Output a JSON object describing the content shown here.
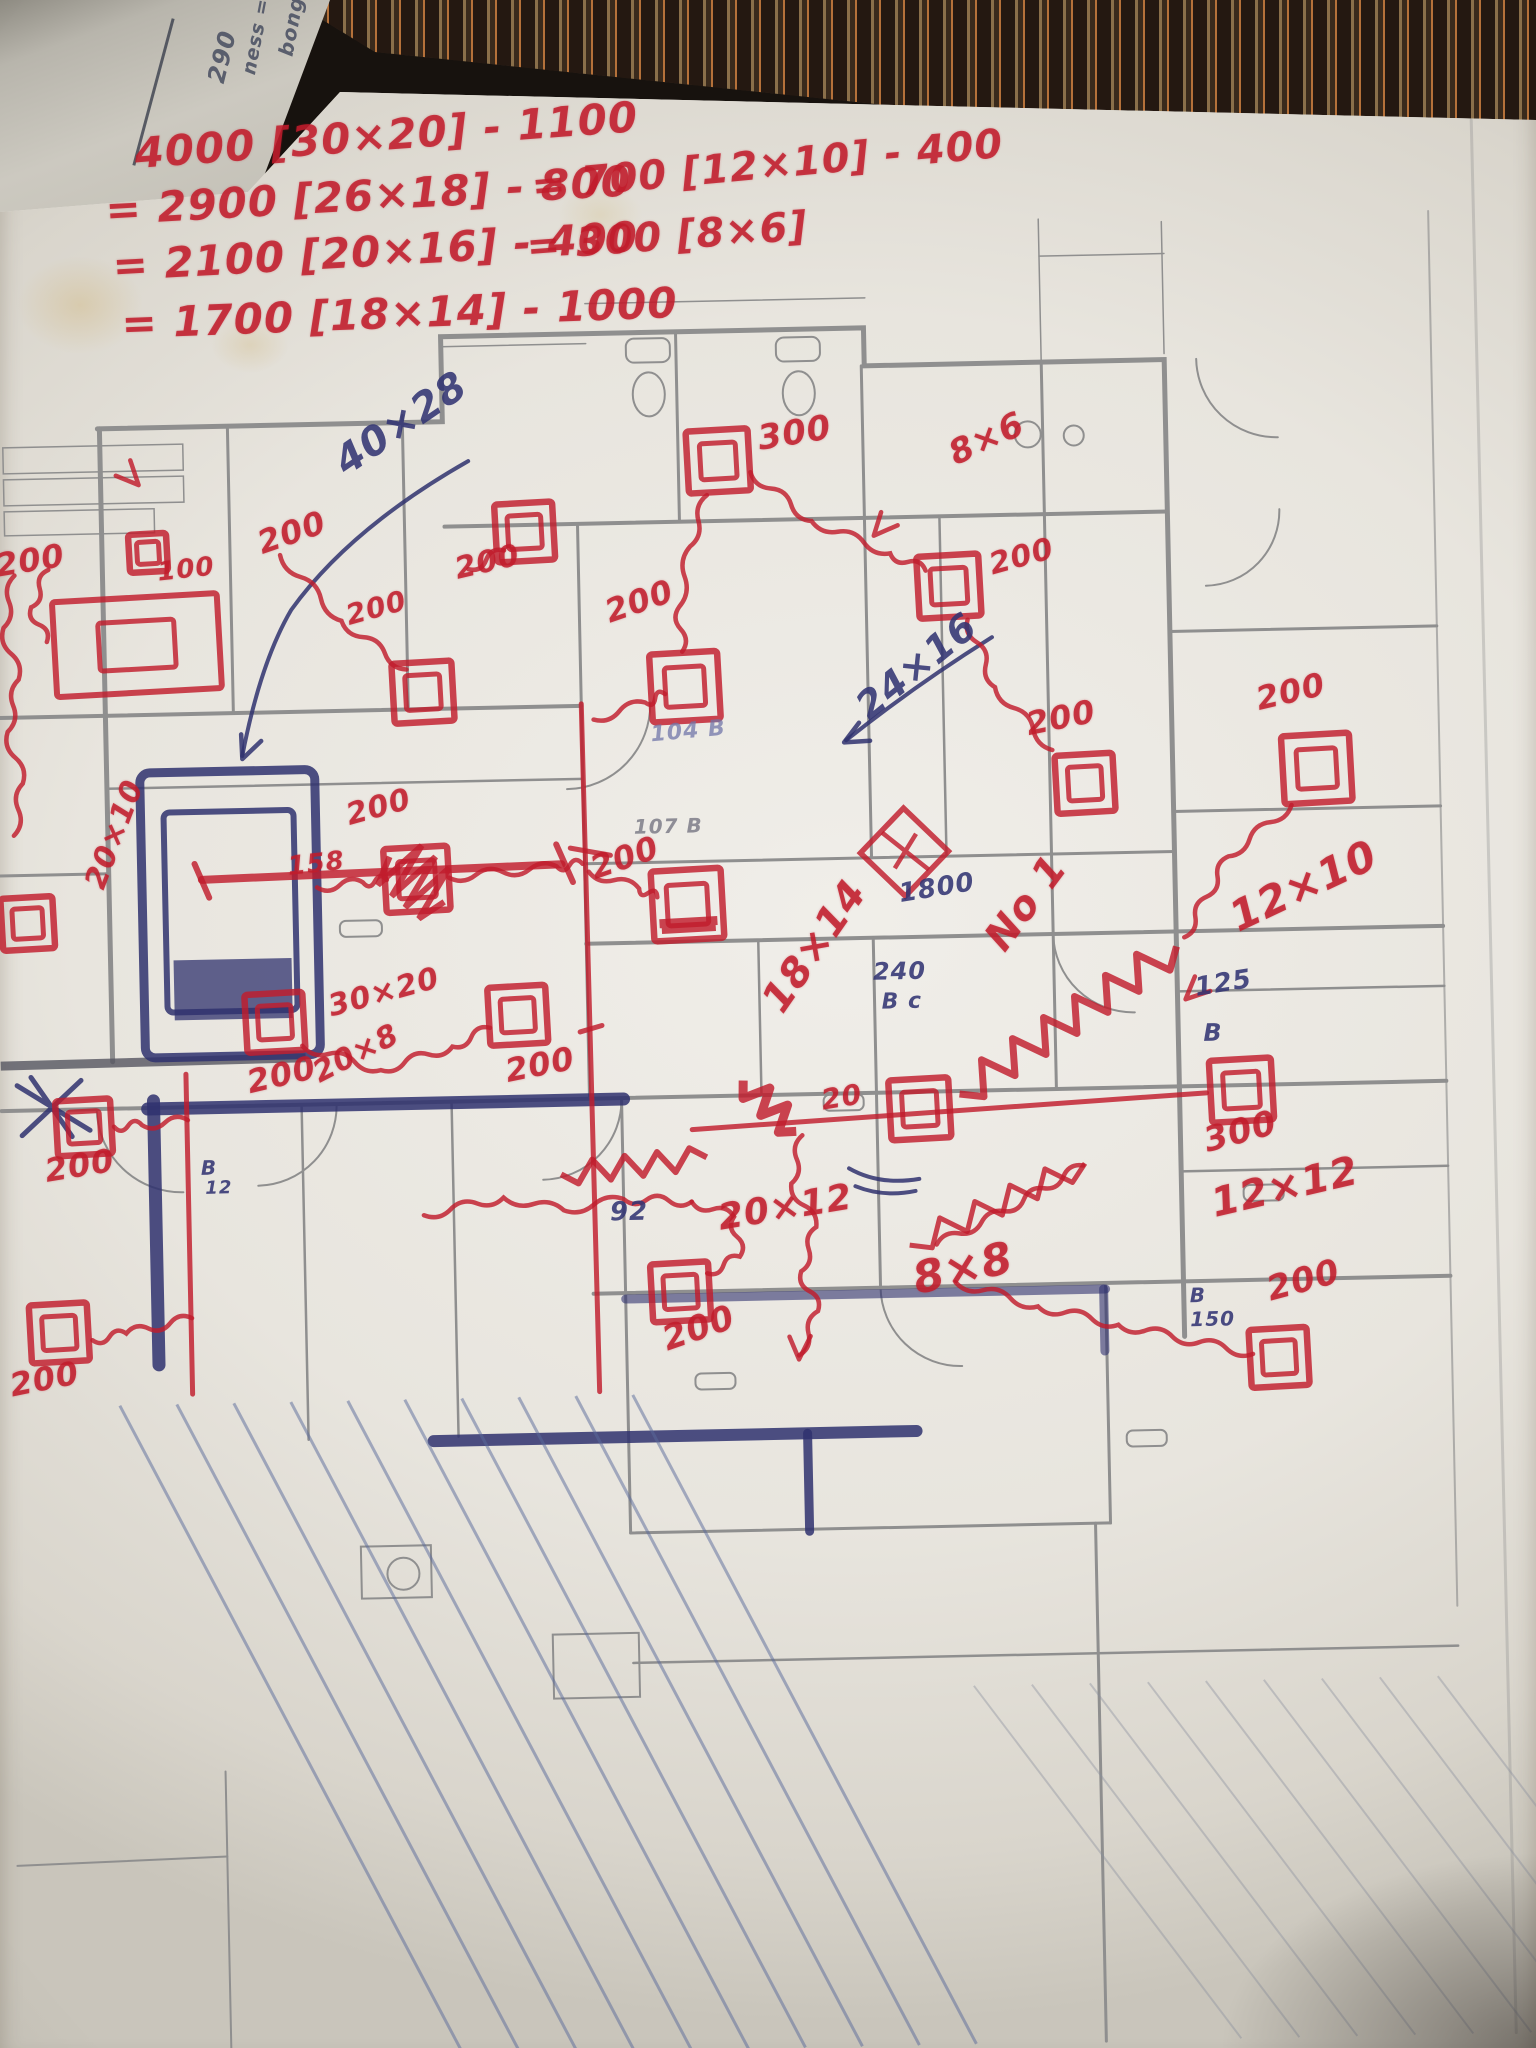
{
  "colors": {
    "red_marker": "#c11c2c",
    "blue_pen": "#32346f",
    "pencil": "#767682",
    "plan_gray": "#8f8f8f"
  },
  "side_sheet": {
    "lines": [
      {
        "text": "bong = 6",
        "x": 296,
        "y": 44,
        "rot": -78,
        "size": 20
      },
      {
        "text": "ness =",
        "x": 260,
        "y": 62,
        "rot": -78,
        "size": 19
      },
      {
        "text": "290",
        "x": 224,
        "y": 68,
        "rot": -75,
        "size": 24
      }
    ]
  },
  "calc_notes": [
    {
      "text": "4000 [30×20] - 1100",
      "x": 152,
      "y": 120,
      "rot": -3,
      "size": 42,
      "ink": "red"
    },
    {
      "text": "= 2900 [26×18] - 800",
      "x": 122,
      "y": 176,
      "rot": -2,
      "size": 42,
      "ink": "red"
    },
    {
      "text": "= 2100 [20×16] - 400",
      "x": 128,
      "y": 232,
      "rot": -2,
      "size": 42,
      "ink": "red"
    },
    {
      "text": "= 1700 [18×14] - 1000",
      "x": 136,
      "y": 290,
      "rot": -1,
      "size": 42,
      "ink": "red"
    },
    {
      "text": "= 700 [12×10] - 400",
      "x": 548,
      "y": 162,
      "rot": -4,
      "size": 40,
      "ink": "red"
    },
    {
      "text": "= 300 [8×6]",
      "x": 542,
      "y": 222,
      "rot": -3,
      "size": 40,
      "ink": "red"
    }
  ],
  "plan_labels": [
    {
      "text": "200",
      "x": 3,
      "y": 534,
      "rot": -8,
      "size": 32,
      "ink": "red"
    },
    {
      "text": "100",
      "x": 166,
      "y": 547,
      "rot": -5,
      "size": 26,
      "ink": "red"
    },
    {
      "text": "200",
      "x": 264,
      "y": 518,
      "rot": -18,
      "size": 32,
      "ink": "red"
    },
    {
      "text": "200",
      "x": 462,
      "y": 549,
      "rot": -12,
      "size": 30,
      "ink": "red"
    },
    {
      "text": "200",
      "x": 352,
      "y": 594,
      "rot": -14,
      "size": 28,
      "ink": "red"
    },
    {
      "text": "40×28",
      "x": 340,
      "y": 440,
      "rot": -33,
      "size": 40,
      "ink": "blue"
    },
    {
      "text": "300",
      "x": 768,
      "y": 422,
      "rot": -8,
      "size": 34,
      "ink": "red"
    },
    {
      "text": "8×6",
      "x": 956,
      "y": 444,
      "rot": -24,
      "size": 34,
      "ink": "red"
    },
    {
      "text": "200",
      "x": 996,
      "y": 556,
      "rot": -14,
      "size": 30,
      "ink": "red"
    },
    {
      "text": "200",
      "x": 1030,
      "y": 714,
      "rot": -10,
      "size": 32,
      "ink": "red"
    },
    {
      "text": "200",
      "x": 1260,
      "y": 694,
      "rot": -12,
      "size": 32,
      "ink": "red"
    },
    {
      "text": "200",
      "x": 610,
      "y": 594,
      "rot": -18,
      "size": 32,
      "ink": "red"
    },
    {
      "text": "24×16",
      "x": 856,
      "y": 698,
      "rot": -38,
      "size": 38,
      "ink": "blue"
    },
    {
      "text": "104 B",
      "x": 656,
      "y": 722,
      "rot": -4,
      "size": 22,
      "ink": "fadedblue"
    },
    {
      "text": "107 B",
      "x": 638,
      "y": 814,
      "rot": 0,
      "size": 20,
      "ink": "pencil"
    },
    {
      "text": "200",
      "x": 590,
      "y": 850,
      "rot": -18,
      "size": 32,
      "ink": "red"
    },
    {
      "text": "158",
      "x": 290,
      "y": 844,
      "rot": -5,
      "size": 26,
      "ink": "red"
    },
    {
      "text": "200",
      "x": 348,
      "y": 793,
      "rot": -14,
      "size": 30,
      "ink": "red"
    },
    {
      "text": "30×20",
      "x": 326,
      "y": 984,
      "rot": -14,
      "size": 30,
      "ink": "red"
    },
    {
      "text": "20×10",
      "x": 84,
      "y": 868,
      "rot": -68,
      "size": 30,
      "ink": "red"
    },
    {
      "text": "20×8",
      "x": 308,
      "y": 1052,
      "rot": -26,
      "size": 30,
      "ink": "red"
    },
    {
      "text": "1800",
      "x": 900,
      "y": 884,
      "rot": -8,
      "size": 26,
      "ink": "blue"
    },
    {
      "text": "18×14",
      "x": 756,
      "y": 996,
      "rot": -54,
      "size": 40,
      "ink": "red"
    },
    {
      "text": "240",
      "x": 874,
      "y": 962,
      "rot": 0,
      "size": 24,
      "ink": "blue"
    },
    {
      "text": "B c",
      "x": 882,
      "y": 994,
      "rot": 0,
      "size": 22,
      "ink": "blue"
    },
    {
      "text": "No 1",
      "x": 980,
      "y": 938,
      "rot": -52,
      "size": 40,
      "ink": "red"
    },
    {
      "text": "125",
      "x": 1194,
      "y": 984,
      "rot": -8,
      "size": 26,
      "ink": "blue"
    },
    {
      "text": "12×10",
      "x": 1226,
      "y": 910,
      "rot": -24,
      "size": 42,
      "ink": "red"
    },
    {
      "text": "B",
      "x": 1203,
      "y": 1030,
      "rot": 0,
      "size": 24,
      "ink": "blue"
    },
    {
      "text": "300",
      "x": 1198,
      "y": 1134,
      "rot": -14,
      "size": 34,
      "ink": "red"
    },
    {
      "text": "12×12",
      "x": 1204,
      "y": 1194,
      "rot": -12,
      "size": 40,
      "ink": "red"
    },
    {
      "text": "20",
      "x": 818,
      "y": 1088,
      "rot": -8,
      "size": 28,
      "ink": "red"
    },
    {
      "text": "92",
      "x": 606,
      "y": 1196,
      "rot": 0,
      "size": 26,
      "ink": "blue"
    },
    {
      "text": "20×12",
      "x": 712,
      "y": 1200,
      "rot": -8,
      "size": 36,
      "ink": "red"
    },
    {
      "text": "8×8",
      "x": 904,
      "y": 1262,
      "rot": -12,
      "size": 44,
      "ink": "red"
    },
    {
      "text": "200",
      "x": 652,
      "y": 1322,
      "rot": -18,
      "size": 34,
      "ink": "red"
    },
    {
      "text": "200",
      "x": 40,
      "y": 1140,
      "rot": -8,
      "size": 32,
      "ink": "red"
    },
    {
      "text": "200",
      "x": 0,
      "y": 1354,
      "rot": -10,
      "size": 32,
      "ink": "red"
    },
    {
      "text": "200",
      "x": 243,
      "y": 1056,
      "rot": -12,
      "size": 32,
      "ink": "red"
    },
    {
      "text": "200",
      "x": 502,
      "y": 1050,
      "rot": -10,
      "size": 32,
      "ink": "red"
    },
    {
      "text": "200",
      "x": 1258,
      "y": 1284,
      "rot": -14,
      "size": 34,
      "ink": "red"
    },
    {
      "text": "B",
      "x": 1184,
      "y": 1294,
      "rot": 0,
      "size": 20,
      "ink": "blue"
    },
    {
      "text": "150",
      "x": 1184,
      "y": 1318,
      "rot": 0,
      "size": 20,
      "ink": "blue"
    },
    {
      "text": "B",
      "x": 198,
      "y": 1146,
      "rot": 0,
      "size": 20,
      "ink": "blue"
    },
    {
      "text": "12",
      "x": 202,
      "y": 1168,
      "rot": 0,
      "size": 18,
      "ink": "blue"
    }
  ],
  "diffusers": [
    {
      "cx": 145,
      "cy": 632,
      "w": 165,
      "h": 95
    },
    {
      "cx": 158,
      "cy": 540,
      "s": 38
    },
    {
      "cx": 730,
      "cy": 460,
      "s": 62
    },
    {
      "cx": 430,
      "cy": 685,
      "s": 60
    },
    {
      "cx": 535,
      "cy": 527,
      "s": 58
    },
    {
      "cx": 692,
      "cy": 685,
      "s": 68
    },
    {
      "cx": 958,
      "cy": 590,
      "s": 62
    },
    {
      "cx": 1090,
      "cy": 790,
      "s": 58
    },
    {
      "cx": 1322,
      "cy": 780,
      "s": 68
    },
    {
      "cx": 420,
      "cy": 872,
      "s": 64,
      "scribble": true
    },
    {
      "cx": 690,
      "cy": 903,
      "s": 70,
      "fill": true
    },
    {
      "cx": 918,
      "cy": 1112,
      "s": 60
    },
    {
      "cx": 1240,
      "cy": 1100,
      "s": 62
    },
    {
      "cx": 675,
      "cy": 1290,
      "s": 58
    },
    {
      "cx": 82,
      "cy": 1113,
      "s": 55
    },
    {
      "cx": 53,
      "cy": 1318,
      "s": 58
    },
    {
      "cx": 30,
      "cy": 908,
      "s": 52
    },
    {
      "cx": 275,
      "cy": 1012,
      "s": 58
    },
    {
      "cx": 518,
      "cy": 1010,
      "s": 58
    },
    {
      "cx": 1272,
      "cy": 1368,
      "s": 58
    }
  ],
  "fd_symbol": {
    "cx": 908,
    "cy": 855,
    "r": 44
  },
  "ducts": [
    {
      "pts": [
        [
          58,
          555
        ],
        [
          40,
          592
        ],
        [
          55,
          627
        ]
      ]
    },
    {
      "pts": [
        [
          290,
          545
        ],
        [
          350,
          612
        ],
        [
          414,
          662
        ]
      ]
    },
    {
      "pts": [
        [
          478,
          563
        ],
        [
          514,
          545
        ]
      ]
    },
    {
      "pts": [
        [
          600,
          716
        ],
        [
          652,
          700
        ],
        [
          672,
          692
        ]
      ]
    },
    {
      "pts": [
        [
          762,
          472
        ],
        [
          822,
          522
        ],
        [
          900,
          556
        ],
        [
          935,
          574
        ]
      ]
    },
    {
      "pts": [
        [
          718,
          494
        ],
        [
          700,
          545
        ],
        [
          688,
          605
        ],
        [
          690,
          650
        ]
      ]
    },
    {
      "pts": [
        [
          976,
          624
        ],
        [
          1002,
          692
        ],
        [
          1058,
          756
        ]
      ]
    },
    {
      "pts": [
        [
          1186,
          946
        ],
        [
          1232,
          866
        ],
        [
          1296,
          816
        ]
      ]
    },
    {
      "pts": [
        [
          320,
          878
        ],
        [
          366,
          874
        ],
        [
          390,
          872
        ]
      ]
    },
    {
      "pts": [
        [
          452,
          871
        ],
        [
          560,
          862
        ],
        [
          586,
          860
        ]
      ]
    },
    {
      "pts": [
        [
          592,
          868
        ],
        [
          642,
          886
        ],
        [
          660,
          895
        ]
      ]
    },
    {
      "pts": [
        [
          1080,
          1172
        ],
        [
          1000,
          1216
        ],
        [
          932,
          1248
        ]
      ]
    },
    {
      "pts": [
        [
          950,
          1286
        ],
        [
          1032,
          1312
        ],
        [
          1112,
          1332
        ],
        [
          1246,
          1364
        ]
      ]
    },
    {
      "pts": [
        [
          420,
          1208
        ],
        [
          500,
          1192
        ],
        [
          560,
          1206
        ],
        [
          620,
          1196
        ],
        [
          688,
          1200
        ]
      ]
    },
    {
      "pts": [
        [
          688,
          1200
        ],
        [
          730,
          1216
        ],
        [
          735,
          1256
        ],
        [
          702,
          1272
        ]
      ]
    },
    {
      "pts": [
        [
          186,
          1108
        ],
        [
          140,
          1112
        ],
        [
          112,
          1113
        ]
      ]
    },
    {
      "pts": [
        [
          186,
          1306
        ],
        [
          120,
          1320
        ],
        [
          86,
          1326
        ]
      ]
    },
    {
      "pts": [
        [
          24,
          560
        ],
        [
          12,
          612
        ],
        [
          26,
          664
        ],
        [
          14,
          716
        ],
        [
          28,
          768
        ],
        [
          18,
          820
        ]
      ]
    },
    {
      "pts": [
        [
          302,
          1036
        ],
        [
          380,
          1062
        ],
        [
          452,
          1040
        ],
        [
          490,
          1022
        ]
      ]
    },
    {
      "pts": [
        [
          800,
          1136
        ],
        [
          788,
          1184
        ],
        [
          812,
          1228
        ],
        [
          796,
          1272
        ],
        [
          812,
          1312
        ],
        [
          792,
          1356
        ]
      ]
    }
  ],
  "mains": [
    {
      "x1": 958,
      "y1": 1098,
      "x2": 1178,
      "y2": 955,
      "amp": 16,
      "seg": 14,
      "w": 7
    },
    {
      "x1": 558,
      "y1": 1170,
      "x2": 704,
      "y2": 1156,
      "amp": 11,
      "seg": 9,
      "w": 6
    },
    {
      "x1": 742,
      "y1": 1080,
      "x2": 794,
      "y2": 1132,
      "amp": 13,
      "seg": 6,
      "w": 9
    },
    {
      "x1": 905,
      "y1": 1248,
      "x2": 1082,
      "y2": 1170,
      "amp": 12,
      "seg": 10,
      "w": 5
    }
  ],
  "risers": [
    {
      "x1": 588,
      "y1": 700,
      "x2": 592,
      "y2": 1388,
      "w": 5
    },
    {
      "x1": 185,
      "y1": 1062,
      "x2": 185,
      "y2": 1382,
      "w": 5
    },
    {
      "x1": 690,
      "y1": 1128,
      "x2": 1205,
      "y2": 1102,
      "w": 5
    },
    {
      "x1": 205,
      "y1": 868,
      "x2": 565,
      "y2": 860,
      "w": 8
    }
  ],
  "ticks": [
    {
      "x1": 560,
      "y1": 840,
      "x2": 576,
      "y2": 878,
      "w": 6
    },
    {
      "x1": 198,
      "y1": 852,
      "x2": 212,
      "y2": 886,
      "w": 6
    },
    {
      "x1": 574,
      "y1": 844,
      "x2": 614,
      "y2": 852,
      "w": 5
    },
    {
      "x1": 580,
      "y1": 1028,
      "x2": 602,
      "y2": 1022,
      "w": 5
    }
  ],
  "arrows": [
    {
      "x": 150,
      "y": 472,
      "ang": 50,
      "ink": "red"
    },
    {
      "x": 884,
      "y": 538,
      "ang": 135,
      "ink": "red"
    },
    {
      "x": 850,
      "y": 744,
      "ang": 155,
      "ink": "blue"
    },
    {
      "x": 1186,
      "y": 1008,
      "ang": 140,
      "ink": "red"
    },
    {
      "x": 792,
      "y": 1360,
      "ang": 95,
      "ink": "red"
    },
    {
      "x": 248,
      "y": 748,
      "ang": 115,
      "ink": "blue"
    }
  ],
  "hatch": {
    "blue": {
      "x0": 112,
      "y0": 1392,
      "dx": 57,
      "count": 10,
      "run": 330,
      "y1": 2048
    },
    "pencil": {
      "x0": 960,
      "y0": 1690,
      "dx": 58,
      "count": 9,
      "run": 260,
      "y1": 2048
    }
  }
}
